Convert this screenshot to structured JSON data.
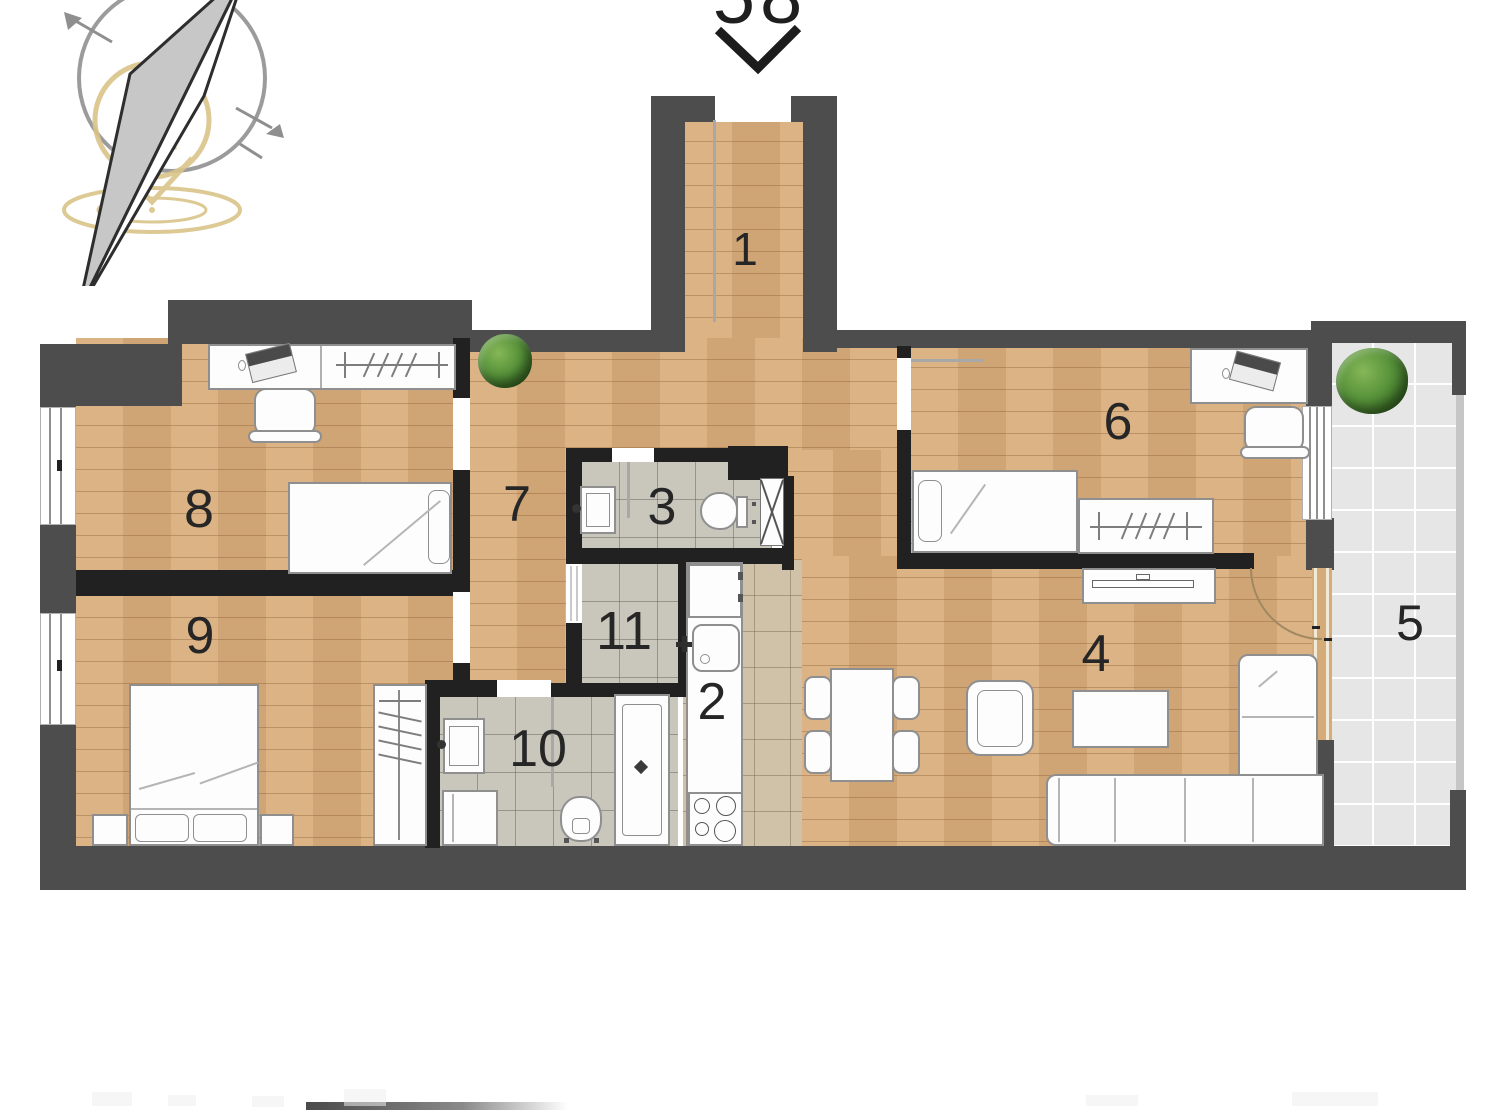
{
  "header": {
    "unit_number": "58"
  },
  "rooms": {
    "r1": {
      "label": "1"
    },
    "r2": {
      "label": "2"
    },
    "r3": {
      "label": "3"
    },
    "r4": {
      "label": "4"
    },
    "r5": {
      "label": "5"
    },
    "r6": {
      "label": "6"
    },
    "r7": {
      "label": "7"
    },
    "r8": {
      "label": "8"
    },
    "r9": {
      "label": "9"
    },
    "r10": {
      "label": "10"
    },
    "r11": {
      "label": "11"
    }
  },
  "colors": {
    "wall_outer": "#4d4d4d",
    "wall_inner": "#212121",
    "wood_floor": "#d9ae7d",
    "bath_tile": "#c9c6bc",
    "kitchen_tile": "#cfc2a9",
    "balcony_tile": "#e6e6e6",
    "logo_gold": "#d9c489",
    "compass_gray": "#9b9b9b",
    "plant_green": "#57923a"
  }
}
